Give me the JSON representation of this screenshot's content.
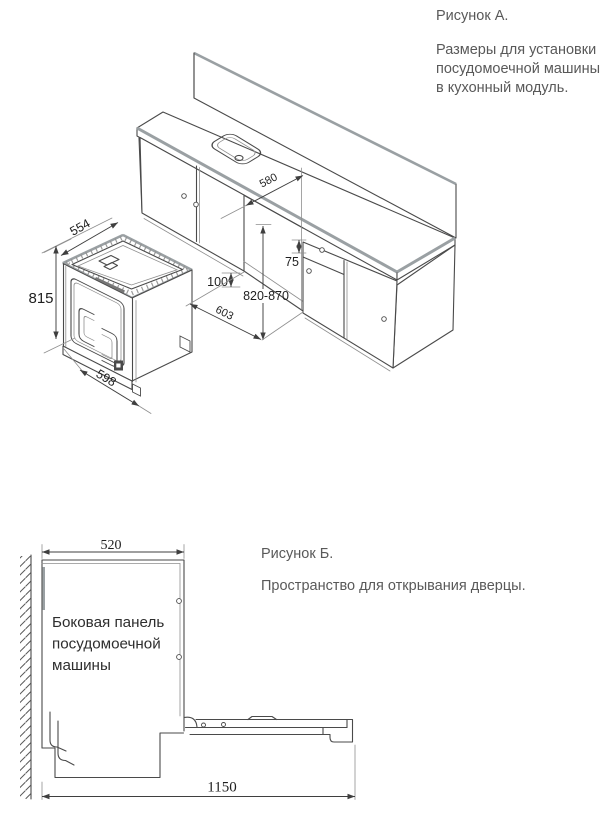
{
  "document": {
    "figure_a": {
      "title": "Рисунок А.",
      "description_lines": [
        "Размеры для установки",
        "посудомоечной машины",
        "в кухонный модуль."
      ],
      "dimensions": {
        "dishwasher_depth": "554",
        "dishwasher_height": "815",
        "dishwasher_width": "598",
        "niche_depth_top": "580",
        "top_gap": "75",
        "plinth_height": "100",
        "niche_height": "820-870",
        "niche_width": "603"
      }
    },
    "figure_b": {
      "title": "Рисунок Б.",
      "description": "Пространство для открывания дверцы.",
      "side_panel_label_lines": [
        "Боковая панель",
        "посудомоечной",
        "машины"
      ],
      "dimensions": {
        "panel_depth": "520",
        "open_door_clearance": "1150"
      }
    },
    "colors": {
      "line": "#4a4a4a",
      "accent_edge": "#9aa0a3",
      "body_text": "#595959",
      "dim_text": "#1f1f1f"
    }
  }
}
